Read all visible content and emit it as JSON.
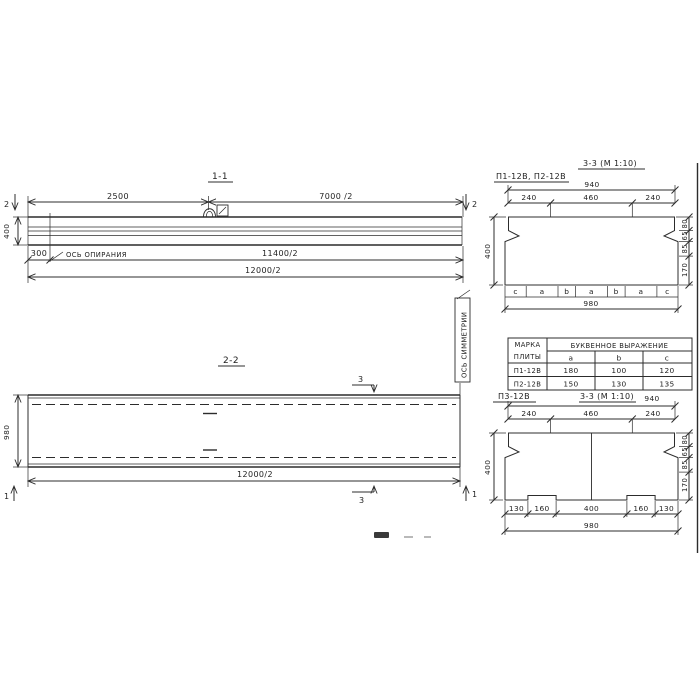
{
  "colors": {
    "ink": "#2c2c2c",
    "paper": "#ffffff"
  },
  "s11": {
    "title": "1-1",
    "mark_left": "2",
    "mark_right": "2",
    "dim_2500": "2500",
    "dim_7000": "7000 /2",
    "dim_400": "400",
    "dim_300": "300",
    "support_axis": "ОСЬ ОПИРАНИЯ",
    "dim_11400": "11400/2",
    "dim_12000": "12000/2"
  },
  "s22": {
    "title": "2-2",
    "mark_3_top": "3",
    "mark_3_bottom": "3",
    "mark_1_left": "1",
    "mark_1_right": "1",
    "dim_980": "980",
    "dim_12000": "12000/2",
    "symmetry_axis": "ОСЬ СИММЕТРИИ"
  },
  "s33a": {
    "label": "П1-12В, П2-12В",
    "title": "3-3 (М 1:10)",
    "dim_940": "940",
    "seg": [
      "240",
      "460",
      "240"
    ],
    "dim_400": "400",
    "right_dims": [
      "80",
      "65",
      "85",
      "170"
    ],
    "letters": [
      "c",
      "a",
      "b",
      "a",
      "b",
      "a",
      "c"
    ],
    "dim_980": "980"
  },
  "s33b": {
    "label": "П3-12В",
    "title": "3-3 (М 1:10)",
    "dim_940": "940",
    "seg": [
      "240",
      "460",
      "240"
    ],
    "dim_400": "400",
    "right_dims": [
      "80",
      "65",
      "85",
      "170"
    ],
    "bottom_seg": [
      "130",
      "160",
      "400",
      "160",
      "130"
    ],
    "dim_980": "980"
  },
  "table": {
    "col_mark_line1": "МАРКА",
    "col_mark_line2": "ПЛИТЫ",
    "header": "БУКВЕННОЕ  ВЫРАЖЕНИЕ",
    "cols": [
      "a",
      "b",
      "c"
    ],
    "rows": [
      {
        "mark": "П1-12В",
        "a": "180",
        "b": "100",
        "c": "120"
      },
      {
        "mark": "П2-12В",
        "a": "150",
        "b": "130",
        "c": "135"
      }
    ]
  }
}
